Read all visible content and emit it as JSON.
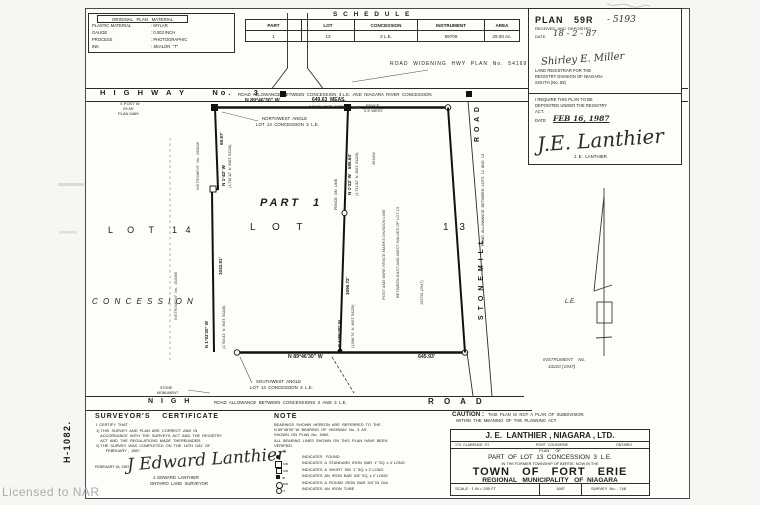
{
  "meta": {
    "watermark": "Licensed to NAR",
    "margin_code": "H-1082."
  },
  "stamp": {
    "title": "ORIGINAL   PLAN   MATERIAL",
    "rows": [
      {
        "k": "PLASTIC MATERIAL",
        "v": ": MYLAR"
      },
      {
        "k": "GAUGE",
        "v": ": 0.003 INCH"
      },
      {
        "k": "PROCESS",
        "v": ": PHOTOGRAPHIC"
      },
      {
        "k": "INK",
        "v": ": SEALON  \"T\""
      }
    ]
  },
  "schedule": {
    "title": "S C H E D U L E",
    "headers": [
      "PART",
      "LOT",
      "CONCESSION",
      "INSTRUMENT",
      "AREA"
    ],
    "row": [
      "1",
      "13",
      "3  L.E.",
      "59709",
      "29.00  Ac."
    ]
  },
  "registry": {
    "plan_label": "PLAN   59R",
    "plan_number": "- 5193",
    "received": "RECEIVED  AND  DEPOSITED",
    "date_label": "DATE",
    "date_value": "18 - 2 - 87",
    "registrar_signature": "Shirley E. Miller",
    "registrar_line1": "LAND REGISTRAR FOR THE",
    "registrar_line2": "REGISTRY DIVISION OF NIAGARA",
    "registrar_line3": "SOUTH (No. 59)",
    "require_line1": "I REQUIRE THIS PLAN TO BE",
    "require_line2": "DEPOSITED UNDER THE REGISTRY",
    "require_line3": "ACT.",
    "date2_label": "DATE",
    "date2_value": "FEB 16, 1987",
    "surveyor_signature": "J.E. Lanthier",
    "surveyor_name": "J. E.  LANTHIER"
  },
  "drawing": {
    "highway": "H I G H W A Y     No.    3",
    "highway_allowance": "ROAD  ALLOWANCE  BETWEEN  CONCESSION  3 L.E.  AND  NIAGARA  RIVER  CONCESSION",
    "road_widening": "ROAD  WIDENING  HWY  PLAN  No.  54169",
    "post_note1": "X POST W",
    "post_note2": "29.55'",
    "post_note3": "PLAN 5469",
    "north_bearing": "N 89°46'30\" W",
    "north_meas": "649.63  MEAS.",
    "north_inst": "649.56'  INST.  54228",
    "fence_west1": "FENCE",
    "fence_west2": "2.5' WEST",
    "nw_angle1": "NORTHWEST  ANGLE",
    "nw_angle2": "LOT  13  CONCESSION  3  L.E.",
    "part_label": "PART  1",
    "lot13_word": "L O T",
    "lot13_num": "1 3",
    "lot14_word": "L O T",
    "lot14_num": "1 4",
    "concession": "C O N C E S S I O N",
    "west_seg1": "68.87'",
    "west_bearing1": "N 1°42' W",
    "west_ref1": "(1,730.32'  N  INST. 54228)",
    "west_seg2": "1043.81'",
    "west_bearing2": "N 1°03'30\" W",
    "west_ref2": "(1,703.81'  N  INST. 54228)",
    "inst_293648": "INSTRUMENT  No.  293648",
    "inst_102088": "INSTRUMENT  No.  102088",
    "inst_363464": "363464",
    "inst_163791": "163791 (1947)",
    "mid_bearing1": "N 1°22' W    586.64'",
    "mid_ref1": "(1,731.52'  N  INST. 54229)",
    "fence_on_line": "FENCE  ON  LINE",
    "mid_seg2": "1096.72'",
    "mid_bearing2": "N 1°06'40\" W",
    "mid_ref2": "(1,096.74'  N  INST. 54229)",
    "division_note1": "POST AND WIRE FENCE MARKS DIVISION LINE",
    "division_note2": "BETWEEN EAST AND WEST HALVES OF LOT 13",
    "stonemill_road_word": "R O A D",
    "stonemill_allowance": "ROAD  ALLOWANCE  BETWEEN  LOTS  12  AND  13",
    "stonemill_name": "S T O N E M I L L",
    "le_label": "L.E.",
    "south_bearing": "N 89°46'30\" W",
    "south_dist": "645.93'",
    "inst_43220a": "INSTRUMENT    No.",
    "inst_43220b": "43220 (1947)",
    "sw_angle1": "SOUTHWEST  ANGLE",
    "sw_angle2": "LOT  13  CONCESSION  3  L.E.",
    "stone_mon1": "STONE",
    "stone_mon2": "MONUMENT",
    "nigh_word": "N I G H",
    "nigh_allowance": "ROAD  ALLOWANCE  BETWEEN  CONCESSIONS  2  AND  3  L.E.",
    "nigh_road_word": "R O A D"
  },
  "certificate": {
    "title": "SURVEYOR'S    CERTIFICATE",
    "intro": "I  CERTIFY  THAT :",
    "item1a": "1) THIS  SURVEY  AND  PLAN  ARE  CORRECT  AND  IN",
    "item1b": "    ACCORDANCE  WITH  THE  SURVEYS  ACT  AND  THE  REGISTRY",
    "item1c": "    ACT  AND  THE  REGULATIONS  MADE  THEREUNDER.",
    "item2a": "2) THE  SURVEY  WAS  COMPLETED  ON  THE  16TH  DAY  OF",
    "item2b": "         FEBRUARY ,  1987 .",
    "date": "FEBRUARY 16, 1987",
    "signature": "J Edward Lanthier",
    "name": "J. EDWARD  LANTHIER",
    "role": "ONTARIO  LAND  SURVEYOR"
  },
  "note": {
    "title": "NOTE",
    "p1a": "BEARINGS  SHOWN  HEREON  ARE  REFERRED  TO  THE",
    "p1b": "N 89°46'30\" W  BEARING  OF  HIGHWAY  No.  3  AS",
    "p1c": "SHOWN  ON  PLAN  No.  5469.",
    "p2a": "ALL  BEARING  LINES  SHOWN  ON  THIS  PLAN  HAVE  BEEN",
    "p2b": "VERIFIED",
    "legend": [
      {
        "sub": "",
        "text": "INDICATES   FOUND"
      },
      {
        "sub": "SIB",
        "text": "INDICATES  A  STANDARD  IRON  BAR  1\" SQ. x 4' LONG"
      },
      {
        "sub": "SIB",
        "text": "INDICATES  A  SHORT  SIB  1\" SQ. x 2' LONG"
      },
      {
        "sub": "IB",
        "text": "INDICATES  AN  IRON  BAR  5/8\" SQ. x 2' LONG"
      },
      {
        "sub": "RIB",
        "text": "INDICATES  A  ROUND  IRON  BAR  3/4\" IN  DIA."
      },
      {
        "sub": "IT",
        "text": "INDICATES  AN  IRON  TUBE"
      }
    ]
  },
  "caution": {
    "label": "CAUTION :",
    "line1": "THIS  PLAN  IS  NOT  A  PLAN  OF  SUBDIVISION",
    "line2": "WITHIN  THE  MEANING  OF  THE  PLANNING  ACT."
  },
  "titleblock": {
    "firm": "J. E.  LANTHIER , NIAGARA , LTD.",
    "address_left": "173  CLARENCE  ST.",
    "address_mid": "PORT  COLBORNE",
    "address_right": "ONTARIO",
    "plan_of": "PLAN      OF",
    "part_line": "PART  OF  LOT  13  CONCESSION  3  L.E.",
    "former_line": "IN THE FORMER TOWNSHIP OF BERTIE, NOW IN THE",
    "town": "TOWN   OF   FORT   ERIE",
    "region": "REGIONAL   MUNICIPALITY   OF  NIAGARA",
    "scale": "SCALE : 1 IN = 200 FT",
    "year": "1987",
    "survey_no": "SURVEY  No. - 748"
  }
}
